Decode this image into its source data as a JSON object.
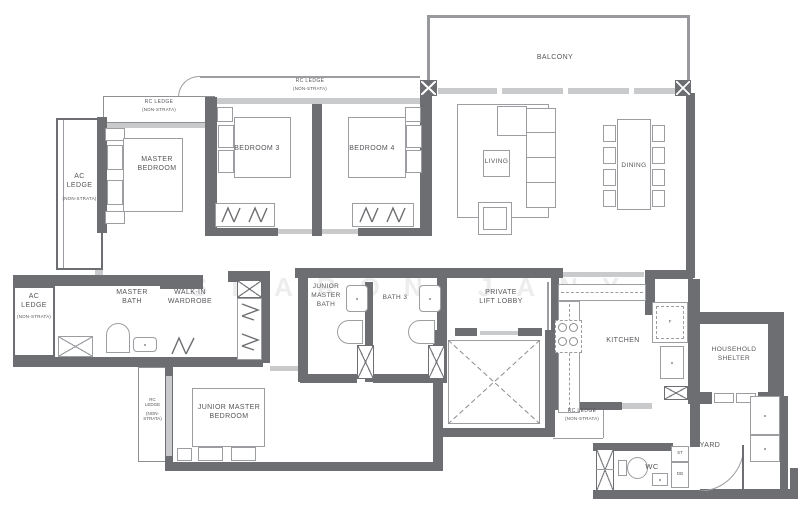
{
  "watermark": "SHARON JANY",
  "palette": {
    "wall": "#6d6e71",
    "window": "#c9cacb",
    "line": "#9b9da0",
    "text": "#55565a"
  },
  "rooms": {
    "balcony": {
      "label": "BALCONY"
    },
    "living": {
      "label": "LIVING"
    },
    "dining": {
      "label": "DINING"
    },
    "master_bedroom": {
      "label": "MASTER\nBEDROOM"
    },
    "bedroom3": {
      "label": "BEDROOM 3"
    },
    "bedroom4": {
      "label": "BEDROOM 4"
    },
    "master_bath": {
      "label": "MASTER\nBATH"
    },
    "walk_in_wardrobe": {
      "label": "WALK-IN\nWARDROBE"
    },
    "junior_master_bath": {
      "label": "JUNIOR\nMASTER\nBATH"
    },
    "bath3": {
      "label": "BATH 3"
    },
    "private_lift_lobby": {
      "label": "PRIVATE\nLIFT LOBBY"
    },
    "kitchen": {
      "label": "KITCHEN"
    },
    "household_shelter": {
      "label": "HOUSEHOLD\nSHELTER"
    },
    "junior_master_bedroom": {
      "label": "JUNIOR MASTER\nBEDROOM"
    },
    "yard": {
      "label": "YARD"
    },
    "wc": {
      "label": "WC"
    }
  },
  "ledges": {
    "rc_top_left": {
      "label": "RC LEDGE",
      "sub": "(NON-STRATA)"
    },
    "rc_top_center": {
      "label": "RC LEDGE",
      "sub": "(NON-STRATA)"
    },
    "ac_top_left": {
      "label": "AC\nLEDGE",
      "sub": "(NON-STRATA)"
    },
    "ac_mid_left": {
      "label": "AC\nLEDGE",
      "sub": "(NON-STRATA)"
    },
    "rc_bottom_left": {
      "label": "RC\nLEDGE",
      "sub": "(NON-\nSTRATA)"
    },
    "rc_yard": {
      "label": "RC LEDGE",
      "sub": "(NON-STRATA)"
    }
  },
  "tags": {
    "st": "ST",
    "db": "DB",
    "fridge": "F"
  }
}
